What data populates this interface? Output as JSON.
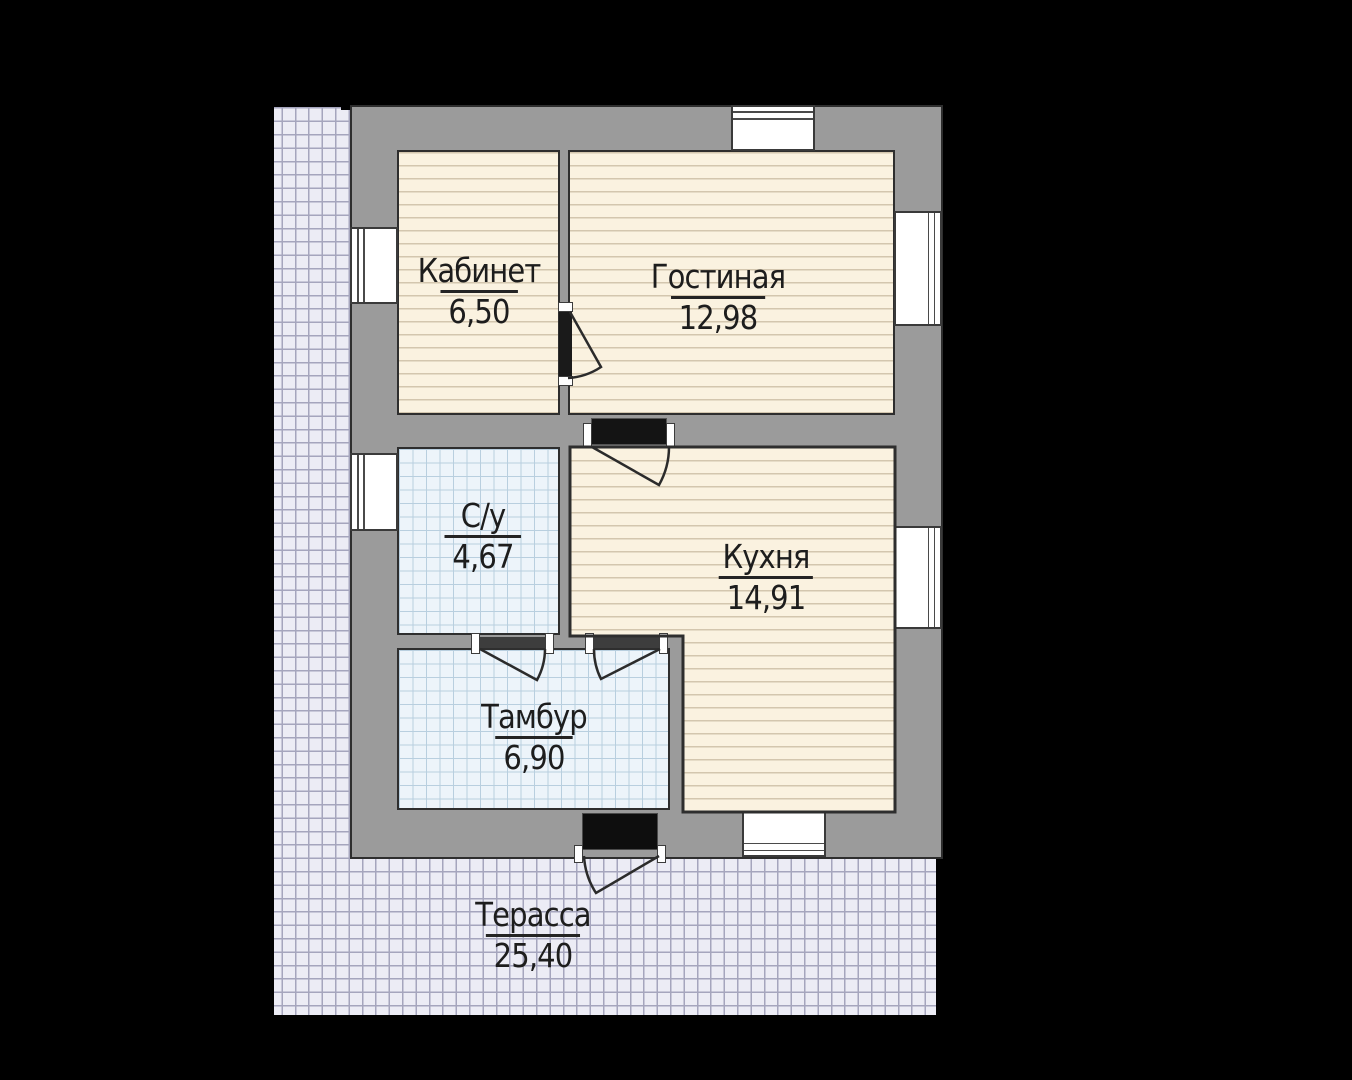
{
  "plan": {
    "rooms": {
      "kabinet": {
        "name": "Кабинет",
        "area": "6,50"
      },
      "gostinaya": {
        "name": "Гостиная",
        "area": "12,98"
      },
      "su": {
        "name": "С/у",
        "area": "4,67"
      },
      "kuhnya": {
        "name": "Кухня",
        "area": "14,91"
      },
      "tambur": {
        "name": "Тамбур",
        "area": "6,90"
      },
      "terassa": {
        "name": "Терасса",
        "area": "25,40"
      }
    },
    "colors": {
      "background": "#000000",
      "wall": "#9b9b9b",
      "outline": "#2e2e2e",
      "wood_floor": "#faf2e0",
      "wood_line": "#d3c6ae",
      "tile_floor": "#edf4fa",
      "tile_line": "#b9cfdf",
      "terrace_floor": "#ececf5",
      "terrace_line": "#a5a5bd",
      "door": "#141414",
      "window": "#ffffff"
    }
  }
}
